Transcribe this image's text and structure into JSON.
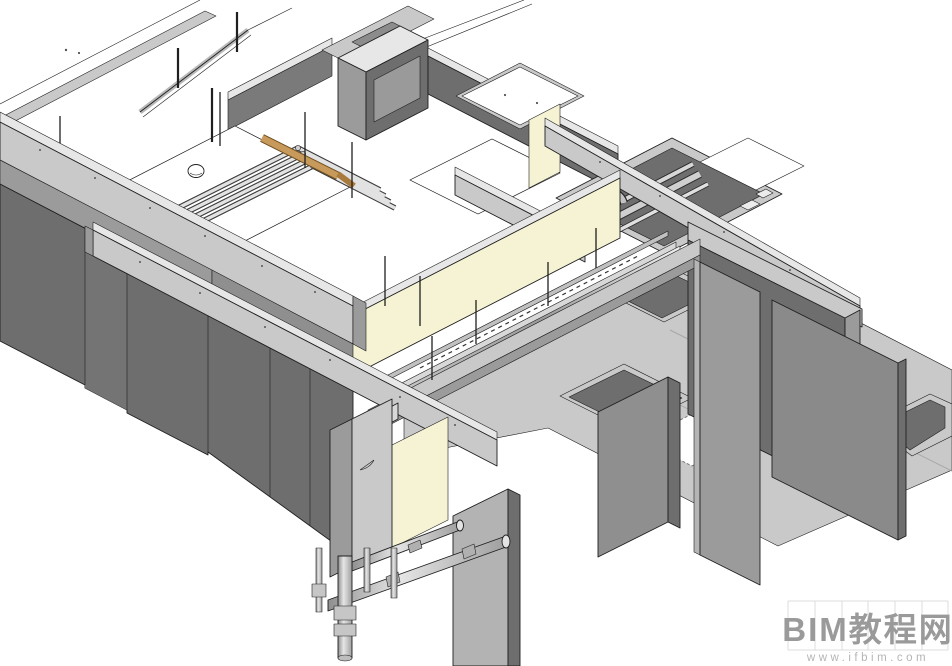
{
  "watermark": {
    "title": "BIM教程网",
    "url": "www.ifbim.com"
  },
  "palette": {
    "background": "#ffffff",
    "outline": "#1f1f1f",
    "wall_dark": "#6e6e6e",
    "wall_dark2": "#7a7a7a",
    "wall_mid": "#9b9b9b",
    "slab_light": "#c9c9c9",
    "slab_lighter": "#e7e7e7",
    "floor_white": "#ffffff",
    "cream_wall": "#f5f3d3",
    "tan_pipe": "#c79a5b",
    "tan_pipe_dark": "#a87a3c",
    "pipe_light": "#d8d8d8",
    "speckle": "#555555",
    "watermark_text": "#9a9a9a",
    "watermark_sub": "#b5b5b5",
    "watermark_grid": "#dcdcdc"
  },
  "scene": {
    "type": "bim-3d-axonometric-view",
    "description": "Revit-style shaded 3D view of a concrete pump-room / trench structure with hanging shear walls, floor pits, piping runs with couplings, and a cream-colored interior corridor wall.",
    "components": [
      "roof-edge-strips",
      "left-parapet-beam",
      "left-shear-wall-row",
      "pump-room-floor",
      "pipe-bundle",
      "tan-pipe",
      "floor-dome-fixture",
      "rooftop-equipment-box",
      "long-interior-wall",
      "white-platform-slab",
      "pipe-trench",
      "arched-pipe-elbow",
      "crossing-concrete-beam",
      "cream-corridor-wall",
      "corridor-pipe-run",
      "floor-pit-grid",
      "right-wall-panels",
      "hanging-wall-panels",
      "vertical-drain-pipes-with-couplings"
    ]
  }
}
